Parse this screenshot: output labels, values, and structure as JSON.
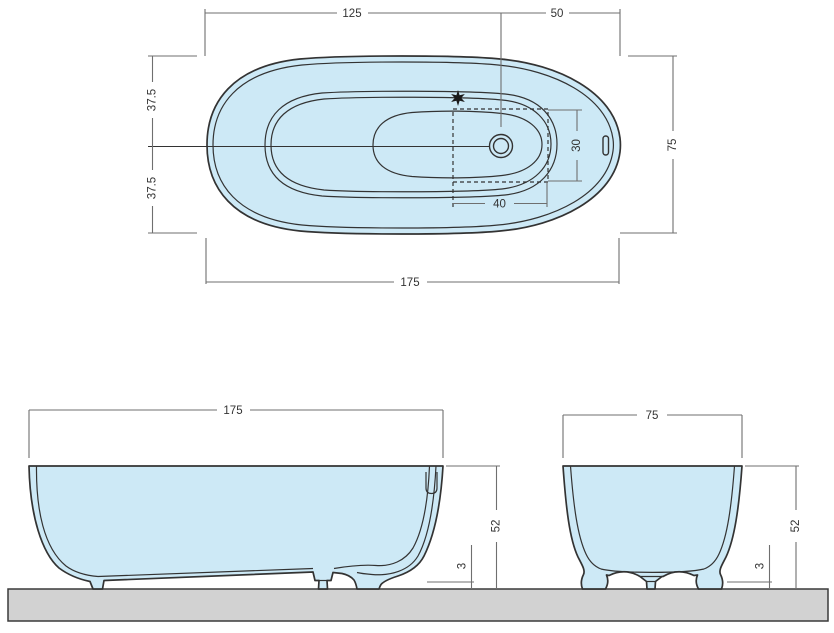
{
  "page": {
    "background": "#ffffff"
  },
  "colors": {
    "tub_fill": "#cde9f6",
    "outline": "#333333",
    "dimension_lines": "#6f6f6f",
    "ground_fill": "#d2d2d2",
    "text": "#333333"
  },
  "plan_view": {
    "dim_top_left": "125",
    "dim_top_right": "50",
    "dim_left_upper": "37.5",
    "dim_left_lower": "37.5",
    "dim_right_width": "75",
    "dim_bottom_length": "175",
    "drain_zone": {
      "dim_width": "40",
      "dim_height": "30"
    },
    "marker": "✱"
  },
  "front_view": {
    "dim_length": "175",
    "dim_height": "52",
    "dim_floor_gap": "3"
  },
  "side_view": {
    "dim_width": "75",
    "dim_height": "52",
    "dim_floor_gap": "3"
  }
}
